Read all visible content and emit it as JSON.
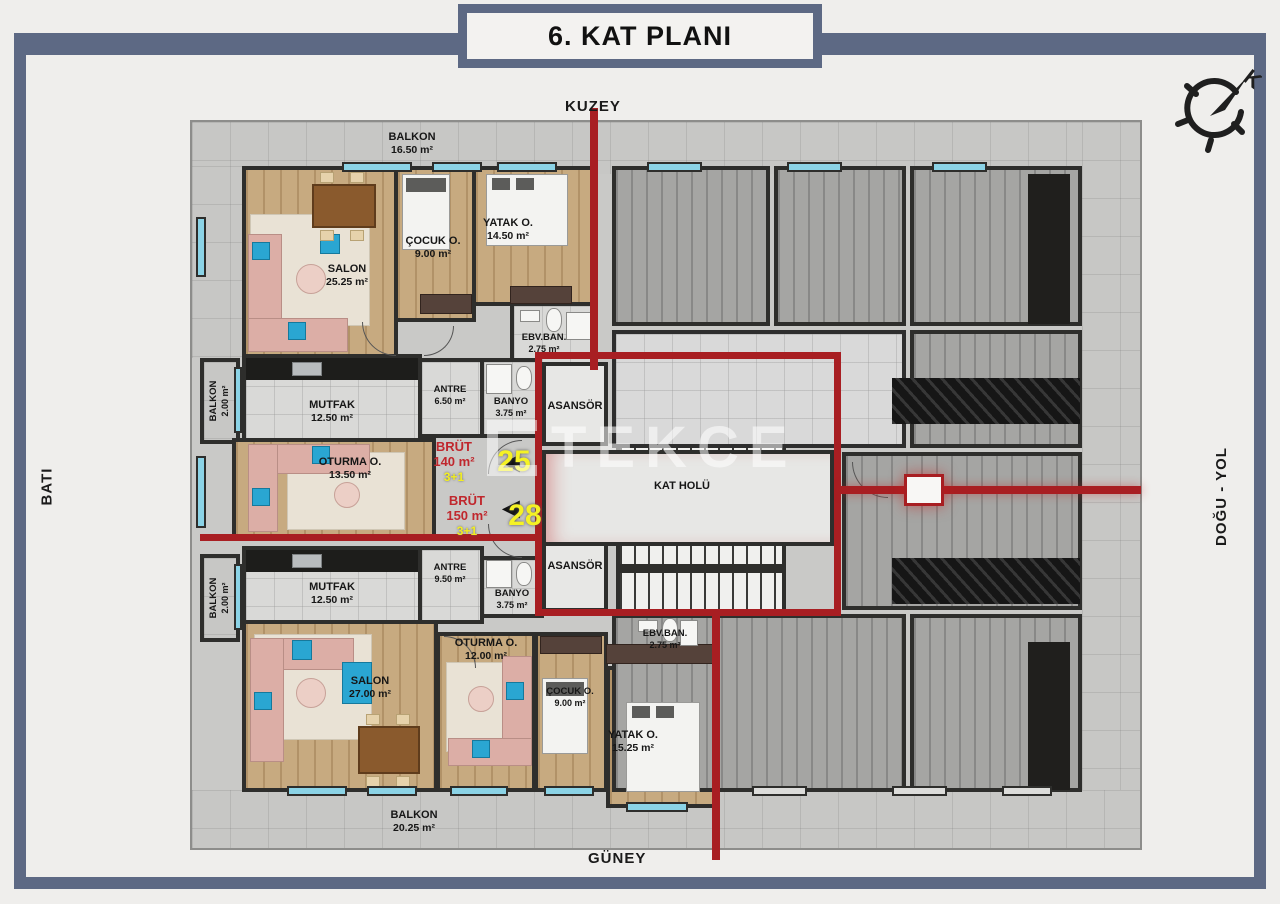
{
  "title": "6. KAT PLANI",
  "compass": {
    "north_letter": "K"
  },
  "directions": {
    "north": "KUZEY",
    "south": "GÜNEY",
    "west": "BATI",
    "east": "DOĞU - YOL"
  },
  "watermark": "TEKCE",
  "colors": {
    "accent_red": "#a81e22",
    "highlight_yellow": "#f5f224",
    "window_cyan": "#8bd3e6",
    "frame_slate": "#5d6984",
    "wood": "#c7aa80"
  },
  "core": {
    "hall": "KAT HOLÜ",
    "elevator_top": "ASANSÖR",
    "elevator_bottom": "ASANSÖR"
  },
  "unit_north": {
    "brut": {
      "label": "BRÜT",
      "area": "140 m²",
      "number": "25",
      "plan_type": "3+1"
    },
    "rooms": {
      "balkon_top": {
        "name": "BALKON",
        "area": "16.50 m²"
      },
      "salon": {
        "name": "SALON",
        "area": "25.25 m²"
      },
      "cocuk": {
        "name": "ÇOCUK O.",
        "area": "9.00 m²"
      },
      "yatak": {
        "name": "YATAK O.",
        "area": "14.50 m²"
      },
      "ebv_ban": {
        "name": "EBV.BAN.",
        "area": "2.75 m²"
      },
      "antre": {
        "name": "ANTRE",
        "area": "6.50 m²"
      },
      "banyo": {
        "name": "BANYO",
        "area": "3.75 m²"
      },
      "mutfak": {
        "name": "MUTFAK",
        "area": "12.50 m²"
      },
      "balkon_side": {
        "name": "BALKON",
        "area": "2.00 m²"
      },
      "oturma": {
        "name": "OTURMA O.",
        "area": "13.50 m²"
      }
    }
  },
  "unit_south": {
    "brut": {
      "label": "BRÜT",
      "area": "150 m²",
      "number": "28",
      "plan_type": "3+1"
    },
    "rooms": {
      "balkon_side": {
        "name": "BALKON",
        "area": "2.00 m²"
      },
      "mutfak": {
        "name": "MUTFAK",
        "area": "12.50 m²"
      },
      "antre": {
        "name": "ANTRE",
        "area": "9.50 m²"
      },
      "banyo": {
        "name": "BANYO",
        "area": "3.75 m²"
      },
      "ebv_ban": {
        "name": "EBV.BAN.",
        "area": "2.75 m²"
      },
      "salon": {
        "name": "SALON",
        "area": "27.00 m²"
      },
      "oturma": {
        "name": "OTURMA O.",
        "area": "12.00 m²"
      },
      "cocuk": {
        "name": "ÇOCUK O.",
        "area": "9.00 m²"
      },
      "yatak": {
        "name": "YATAK O.",
        "area": "15.25 m²"
      },
      "balkon_bottom": {
        "name": "BALKON",
        "area": "20.25 m²"
      }
    }
  }
}
